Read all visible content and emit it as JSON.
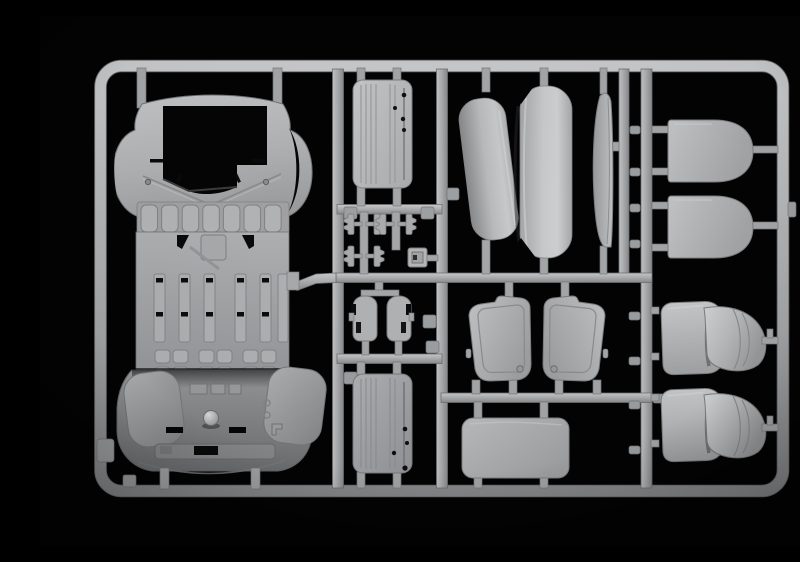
{
  "scene": {
    "description": "Photograph of a light gray injection-moulded plastic model kit sprue (runner frame with vehicle parts) on a black background",
    "background_color": "#000000",
    "plastic_base_color": "#b4b5b7",
    "plastic_highlight_color": "#d0d1d3",
    "plastic_shadow_color": "#707173"
  },
  "sprue": {
    "frame_label": "Rectangular sprue runner frame with internal rails and moulding gates",
    "parts": [
      {
        "name": "cab-body-shell",
        "label": "Truck cab body shell with windscreen opening, wheel arches, grille slats and interior floor tub"
      },
      {
        "name": "ribbed-panel-upper",
        "label": "Ribbed rectangular roof/floor panel with locating holes (upper middle)"
      },
      {
        "name": "hinge-brackets",
        "label": "Six small hinge brackets on sub-runners"
      },
      {
        "name": "small-square-plate",
        "label": "Small square mounting plate"
      },
      {
        "name": "sill-pillar-pair",
        "label": "Pair of small sill / pillar parts"
      },
      {
        "name": "ribbed-panel-lower",
        "label": "Ribbed rectangular roof/floor panel with locating holes (lower middle)"
      },
      {
        "name": "double-curved-backrest",
        "label": "Double curved bench backrest panel"
      },
      {
        "name": "narrow-curved-panel",
        "label": "Narrow curved side panel seen edge-on"
      },
      {
        "name": "rounded-panel-upper",
        "label": "Rounded seat-back panel (upper right)"
      },
      {
        "name": "rounded-panel-lower",
        "label": "Rounded seat-back panel (lower right)"
      },
      {
        "name": "door-card-left",
        "label": "Left door interior card with recessed panel line"
      },
      {
        "name": "door-card-right",
        "label": "Right door interior card with recessed panel line"
      },
      {
        "name": "flat-panel",
        "label": "Flat rectangular panel with rounded corners"
      },
      {
        "name": "seat-upper",
        "label": "Seat with backrest and curved cushion (upper right)"
      },
      {
        "name": "seat-lower",
        "label": "Seat with backrest and curved cushion (lower right)"
      }
    ]
  }
}
